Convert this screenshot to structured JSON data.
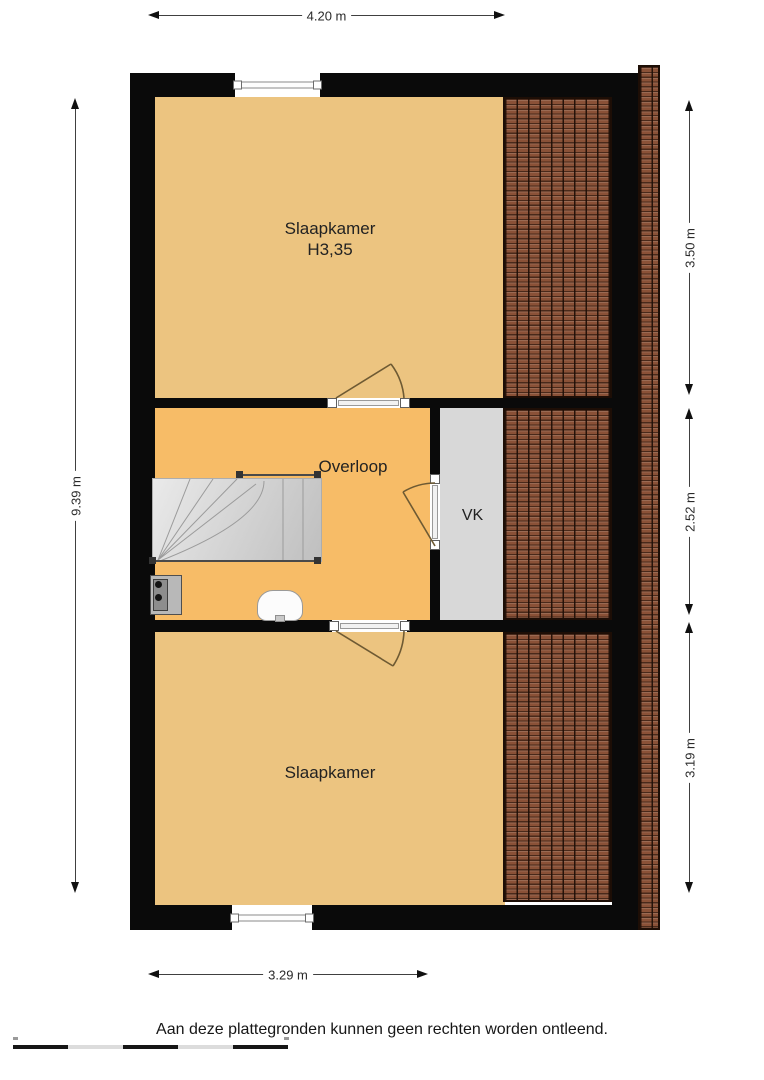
{
  "plan": {
    "rooms": {
      "bedroom_top": {
        "label": "Slaapkamer",
        "height_label": "H3,35"
      },
      "landing": {
        "label": "Overloop"
      },
      "vk": {
        "label": "VK"
      },
      "bedroom_bottom": {
        "label": "Slaapkamer"
      }
    },
    "dimensions": {
      "top": "4.20 m",
      "left": "9.39 m",
      "right_top": "3.50 m",
      "right_middle": "2.52 m",
      "right_bottom": "3.19 m",
      "bottom": "3.29 m"
    },
    "colors": {
      "wall": "#0a0a0a",
      "bedroom_floor": "#ecc480",
      "landing_floor": "#f7bc67",
      "vk_floor": "#d8d8d8",
      "roof_tile": "#8a5137",
      "roof_tile_line": "#1d0e06",
      "stairs_fill": "#d9d9d9",
      "door": "#6e5a33",
      "dimension_line": "#404040"
    }
  },
  "footer": {
    "disclaimer": "Aan deze plattegronden kunnen geen rechten worden ontleend."
  }
}
